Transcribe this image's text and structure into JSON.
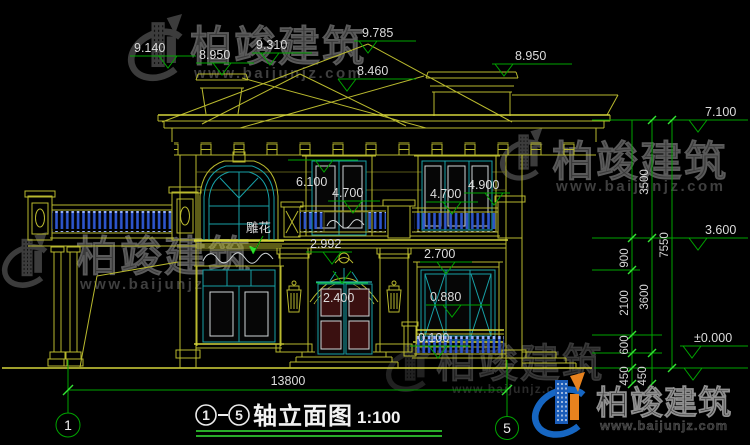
{
  "page": {
    "background": "#000000",
    "type": "CAD elevation drawing"
  },
  "title": {
    "axis_from": "1",
    "axis_to": "5",
    "text": "轴立面图",
    "scale": "1:100"
  },
  "axes": {
    "left": "1",
    "right": "5"
  },
  "labels": {
    "carving": "雕花"
  },
  "elevations": {
    "e9140": "9.140",
    "e8950l": "8.950",
    "e9310": "9.310",
    "e9785": "9.785",
    "e8460": "8.460",
    "e8950r": "8.950",
    "e7100": "7.100",
    "e3600": "3.600",
    "e0000": "±0.000",
    "e6100": "6.100",
    "e4700l": "4.700",
    "e4700r": "4.700",
    "e4900": "4.900",
    "e2992": "2.992",
    "e2700": "2.700",
    "e2400": "2.400",
    "e0880": "0.880",
    "e0100": "0.100"
  },
  "dims": {
    "overall_width": "13800",
    "overall_height": "7550",
    "h3500": "3500",
    "h3600": "3600",
    "h900": "900",
    "h2100": "2100",
    "h600": "600",
    "h450a": "450",
    "h450b": "450"
  },
  "watermark": {
    "name": "柏竣建筑",
    "url": "www.baijunjz.com"
  },
  "colors": {
    "background": "#000000",
    "building_line": "#b9b92e",
    "window_line": "#17a0a6",
    "railing_blue": "#2d55cc",
    "dimension_green": "#00a400",
    "text_white": "#dcdcdc",
    "door_panel": "#3a1010",
    "logo_blue": "#1a5cb8",
    "logo_orange": "#e8821e",
    "watermark_gray": "#3a3a3a"
  }
}
